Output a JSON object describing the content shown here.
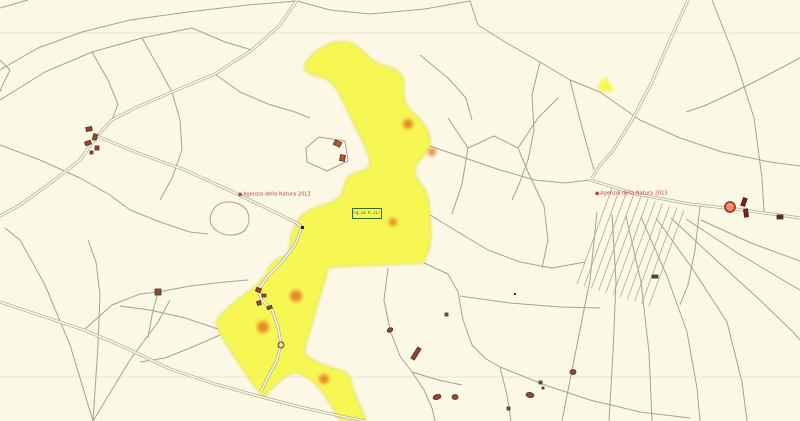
{
  "map": {
    "background_color": "#fbf8e6",
    "parcel_line_color": "#a8a193",
    "road_color": "#b0a99a",
    "faint_line_color": "#ebe5cf",
    "highlight_color": "#f7f73e",
    "highlight_edge_color": "#c9cc3a",
    "marker_orange": "#e2661e",
    "building_fill": "#8a4a2e",
    "building_stroke": "#5a3220",
    "watermark_color": "#cc3333",
    "red_circle_color": "#b03020",
    "watermarks": [
      {
        "logo": "■",
        "text": "Agenzia della Natura 2013",
        "x": 238,
        "y": 192
      },
      {
        "logo": "■",
        "text": "Agenzia della Natura 2013",
        "x": 595,
        "y": 191
      }
    ],
    "parcel_label": {
      "text": "Fg.13 P.117",
      "x": 352,
      "y": 208,
      "border_color": "#2e6b1e",
      "text_color": "#2f5a1f"
    }
  },
  "geometry": {
    "highlight_path": "M347,42 C356,44 362,50 372,60 C382,68 394,64 402,76 C406,84 402,92 405,100 C407,110 414,112 422,122 C428,130 432,138 430,146 C428,154 419,158 415,168 C413,176 420,182 425,190 C429,198 430,206 430,215 C430,228 433,240 428,252 C426,258 424,260 424,263 L330,267 C328,268 327,269 327,271 C325,282 321,292 318,302 C314,318 308,336 304,352 C307,358 318,363 330,367 C339,370 347,371 350,377 C352,386 356,398 361,408 C363,413 365,417 366,421 L340,421 C335,412 330,403 323,393 C318,386 311,379 303,375 C297,372 291,372 285,377 C277,383 270,390 264,397 C258,392 250,380 242,368 C234,356 224,342 218,329 C216,324 216,321 220,316 C227,308 238,299 248,292 C256,286 263,280 267,272 C269,266 272,262 280,258 C286,255 290,252 290,246 C290,238 292,230 297,222 C302,214 310,209 320,206 C330,203 338,200 342,194 C344,188 344,182 348,177 C354,171 364,172 369,167 C372,162 368,152 363,142 C356,128 348,112 341,97 C337,89 334,84 328,80 C322,76 308,76 305,70 C303,64 310,56 318,50 C326,44 338,40 347,42 Z",
    "yellow_mark_path": "M598,86 C600,80 605,76 608,79 C610,82 609,85 613,87 C616,89 612,92 607,92 C602,92 597,90 598,86 Z",
    "roads": [
      "297,0 280,25 252,50 215,74 172,92 135,108 112,120 97,136",
      "97,136 80,160 52,182 20,205 0,216",
      "97,136 135,152 185,170 235,193 270,210 295,222 302,227 295,245 282,262 268,276 258,290 262,300 272,310 278,327 281,344 277,360 268,377 261,392",
      "0,302 42,316 84,330 124,347 170,369 215,384 258,396 300,407 345,417 365,421",
      "688,0 670,40 652,82 632,120 612,152 600,165 592,178",
      "590,180 636,194 690,204 735,209 772,214 800,218"
    ],
    "lines": [
      "0,70 38,48 82,32 130,20 188,12 248,5 297,1",
      "0,100 45,72 92,52 142,38 192,28",
      "0,8 28,0",
      "0,60 10,70 3,84 0,92",
      "192,28 225,42 252,50",
      "92,52 108,80 118,104 112,120",
      "142,38 160,70 172,92",
      "297,1 330,10 370,14 425,9 470,1",
      "470,1 478,25 505,42 540,62 570,80 600,92 640,120",
      "540,62 532,95 534,130 528,160 520,182 512,200",
      "215,74 240,92 268,104 295,112 310,118",
      "172,92 180,120 182,150 172,178 160,200",
      "0,145 40,160 80,178 110,195 130,210",
      "130,210 160,222 190,232 208,234",
      "93,421 70,345 45,285 20,240 5,228",
      "93,421 98,345 100,295 96,262 88,240",
      "93,421 130,360 158,322 170,300",
      "84,330 112,305 140,294 158,292 190,286 225,282 248,280",
      "158,292 152,315 148,338",
      "218,329 185,318 150,310 120,306",
      "220,335 190,348 165,358 140,362",
      "388,268 384,300 390,330 400,356 412,372 424,390 432,408 435,421",
      "412,372 438,380 462,385",
      "424,263 448,274 458,292 463,320 472,345 486,359 500,367",
      "500,367 507,395 511,421",
      "500,367 545,385 590,400 640,412 690,418",
      "460,296 510,303 560,307 600,308",
      "448,118 468,148 462,184 452,214",
      "468,148 494,136 518,148 528,172",
      "518,148 538,118 558,98",
      "528,172 544,206 548,240 542,268",
      "430,146 465,158 500,170 535,180 565,183 590,180",
      "430,215 458,232 488,250 520,262 552,268 585,262",
      "420,55 448,78 466,98 472,120",
      "640,120 680,138 722,152 770,162 800,166",
      "712,0 735,58 754,118 762,178 764,212",
      "800,58 762,78 730,94 704,106 686,112",
      "570,80 578,112 586,142 594,170",
      "700,206 695,250 688,285 680,305",
      "597,212 590,280 576,350 562,421",
      "612,214 616,282 613,352 609,421",
      "626,216 641,282 649,352 652,421",
      "641,217 667,276 687,332 697,388 700,421",
      "656,218 692,268 727,322 742,382 747,421",
      "671,218 716,260 762,302 793,332 800,340",
      "686,219 736,252 786,282 800,290",
      "701,220 751,243 800,261"
    ],
    "closed_outlines": [
      "M212,212 C216,202 230,199 241,205 C250,210 251,221 246,229 C239,237 224,237 216,230 C209,224 209,219 212,212 Z",
      "M306,148 L319,137 L345,141 L348,161 L327,171 L307,162 Z"
    ],
    "faint_lines": [
      "0,33 800,33",
      "0,377 800,377"
    ],
    "hatch": {
      "count": 11,
      "x": 612,
      "y": 188,
      "dx": 7.2,
      "dy": 2.2,
      "len_x": -35,
      "len_y": 96
    },
    "orange_dots": [
      {
        "x": 408,
        "y": 124,
        "r": 5
      },
      {
        "x": 432,
        "y": 152,
        "r": 4
      },
      {
        "x": 393,
        "y": 222,
        "r": 4
      },
      {
        "x": 296,
        "y": 296,
        "r": 6
      },
      {
        "x": 263,
        "y": 327,
        "r": 6
      },
      {
        "x": 324,
        "y": 379,
        "r": 5
      }
    ],
    "red_circle": {
      "x": 730,
      "y": 207,
      "r": 5
    },
    "buildings": [
      {
        "shape": "rect",
        "x": 86,
        "y": 127,
        "w": 6,
        "h": 4,
        "rot": -10
      },
      {
        "shape": "rect",
        "x": 93,
        "y": 134,
        "w": 4,
        "h": 6,
        "rot": 15
      },
      {
        "shape": "rect",
        "x": 85,
        "y": 141,
        "w": 6,
        "h": 4,
        "rot": -20
      },
      {
        "shape": "rect",
        "x": 95,
        "y": 146,
        "w": 4,
        "h": 4,
        "rot": 0
      },
      {
        "shape": "rect",
        "x": 90,
        "y": 151,
        "w": 3,
        "h": 3,
        "rot": 0
      },
      {
        "shape": "rect",
        "x": 334,
        "y": 141,
        "w": 7,
        "h": 5,
        "rot": 25,
        "fill": "#b4552f"
      },
      {
        "shape": "rect",
        "x": 340,
        "y": 155,
        "w": 5,
        "h": 6,
        "rot": 10,
        "fill": "#b4552f"
      },
      {
        "shape": "rect",
        "x": 155,
        "y": 289,
        "w": 6,
        "h": 6,
        "rot": 0
      },
      {
        "shape": "rect",
        "x": 256,
        "y": 288,
        "w": 5,
        "h": 4,
        "rot": 20
      },
      {
        "shape": "rect",
        "x": 262,
        "y": 294,
        "w": 4,
        "h": 3,
        "rot": 0
      },
      {
        "shape": "rect",
        "x": 257,
        "y": 301,
        "w": 4,
        "h": 4,
        "rot": -15
      },
      {
        "shape": "rect",
        "x": 267,
        "y": 306,
        "w": 5,
        "h": 3,
        "rot": -20
      },
      {
        "shape": "circle",
        "x": 281,
        "y": 345,
        "r": 3,
        "fill": "none"
      },
      {
        "shape": "ellipse",
        "x": 390,
        "y": 330,
        "rx": 3,
        "ry": 2,
        "rot": -30
      },
      {
        "shape": "rect",
        "x": 414,
        "y": 347,
        "w": 4,
        "h": 13,
        "rot": 32
      },
      {
        "shape": "ellipse",
        "x": 437,
        "y": 397,
        "rx": 4,
        "ry": 2.5,
        "rot": -15
      },
      {
        "shape": "ellipse",
        "x": 455,
        "y": 397,
        "rx": 3,
        "ry": 2.5,
        "rot": 0
      },
      {
        "shape": "rect",
        "x": 445,
        "y": 313,
        "w": 3,
        "h": 3,
        "rot": 0
      },
      {
        "shape": "rect",
        "x": 514,
        "y": 293,
        "w": 2,
        "h": 2,
        "rot": 0,
        "fill": "#333333",
        "stroke": "none"
      },
      {
        "shape": "ellipse",
        "x": 530,
        "y": 395,
        "rx": 4,
        "ry": 2.5,
        "rot": 10
      },
      {
        "shape": "rect",
        "x": 539,
        "y": 381,
        "w": 3,
        "h": 3,
        "rot": 0
      },
      {
        "shape": "rect",
        "x": 542,
        "y": 387,
        "w": 2,
        "h": 2,
        "rot": 0
      },
      {
        "shape": "ellipse",
        "x": 573,
        "y": 372,
        "rx": 3,
        "ry": 2.5,
        "rot": 0
      },
      {
        "shape": "rect",
        "x": 507,
        "y": 407,
        "w": 3,
        "h": 3,
        "rot": 0
      },
      {
        "shape": "rect",
        "x": 742,
        "y": 198,
        "w": 4,
        "h": 8,
        "rot": 20,
        "fill": "#7a2418",
        "stroke": "#5a180f"
      },
      {
        "shape": "rect",
        "x": 744,
        "y": 209,
        "w": 4,
        "h": 8,
        "rot": -8,
        "fill": "#7a2418",
        "stroke": "#5a180f"
      },
      {
        "shape": "rect",
        "x": 777,
        "y": 215,
        "w": 6,
        "h": 4,
        "rot": 0,
        "fill": "#4a3418"
      },
      {
        "shape": "rect",
        "x": 652,
        "y": 275,
        "w": 6,
        "h": 3,
        "rot": 0,
        "fill": "#3f5426",
        "stroke": "#2c3e1a"
      },
      {
        "shape": "rect",
        "x": 301,
        "y": 226,
        "w": 3,
        "h": 3,
        "rot": 0,
        "fill": "#222222",
        "stroke": "none"
      }
    ]
  }
}
